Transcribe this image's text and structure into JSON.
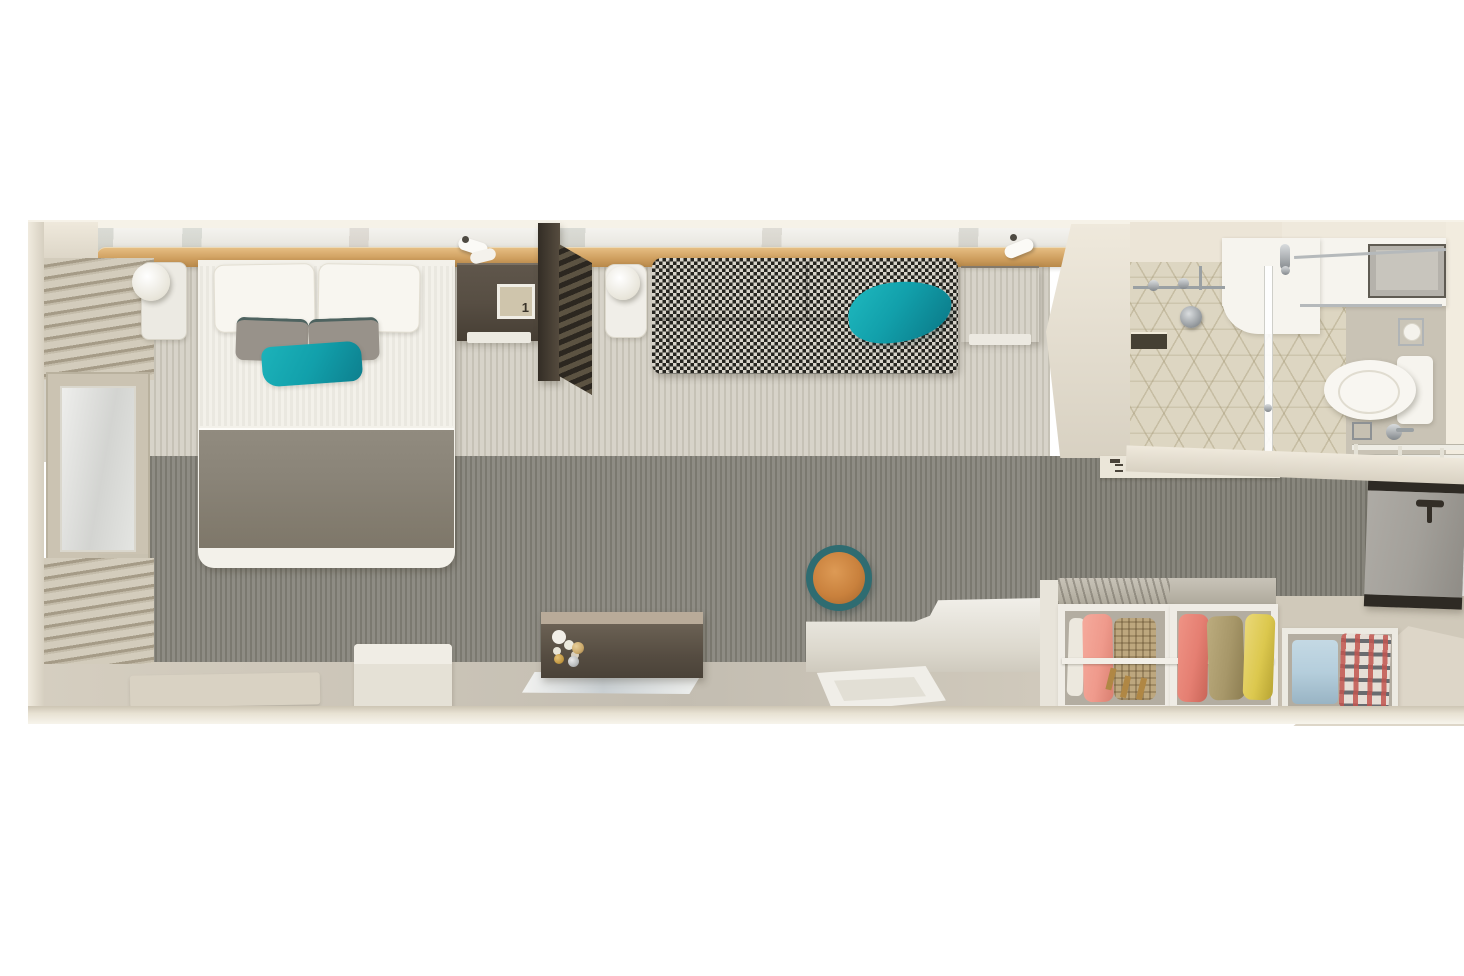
{
  "meta": {
    "label": "Top-down 3D floor plan of a stateroom cabin"
  },
  "artwork": {
    "digit": "1"
  },
  "colors": {
    "wall_cream": "#d8d1c2",
    "wall_light": "#efe9dc",
    "wood": "#cf9f5f",
    "marble": "#ebe9e3",
    "carpet_light": "#d7d3c9",
    "carpet_light_stripe": "#c6c2b6",
    "carpet_dark": "#8e8c84",
    "carpet_dark_stripe": "#7b7970",
    "floor_beige": "#d5cec0",
    "floor_entry": "#d0c9ba",
    "bed_white": "#f3f1ea",
    "blanket_gray": "#8a8478",
    "pillow_gray": "#98928a",
    "teal": "#12a0ab",
    "teal_deep": "#0d7f8e",
    "houndstooth_dark": "#25241f",
    "houndstooth_light": "#d8d4ca",
    "wood_dark": "#574e43",
    "divider_dark": "#3e372d",
    "stool_orange": "#c9813d",
    "stool_ring": "#2f6c71",
    "porcelain": "#f6f4ee",
    "chrome": "#a7abae",
    "tile": "#ddd6c2",
    "bath_floor_right": "#c9c3b5",
    "wardrobe_frame": "#efece5",
    "wardrobe_interior": "#b3ada1",
    "cloth_pink": "#ef9a8c",
    "cloth_salmon": "#e57f72",
    "cloth_tan": "#bda77e",
    "cloth_olive": "#a79769",
    "cloth_yellow": "#dcc84e",
    "cloth_blue": "#b5cedc",
    "door_gray": "#a3a09a",
    "door_trim": "#2e2a24",
    "hanger_gold": "#b08744"
  },
  "items": {
    "plan": "stateroom floor plan",
    "balcony_ledge": "balcony window ledge",
    "desk_ledge": "wooden desk ledge",
    "window": "window with mirror glass",
    "blinds": "window blinds",
    "bed": "queen bed",
    "pillow_white": "white pillow",
    "pillow_gray": "gray accent pillow",
    "pillow_teal": "teal throw pillow",
    "blanket": "gray bed runner",
    "nightstand": "marble nightstand",
    "lamp": "table lamp",
    "desk": "dark wood desk",
    "drawer": "drawer front",
    "picture": "framed artwork",
    "divider": "slatted room divider",
    "side_table": "marble side table",
    "sofa": "houndstooth sofa",
    "reading_light": "wall reading light",
    "sofa_side_table": "dark wood side table",
    "partition_wall": "bathroom partition wall",
    "coat_hooks": "coat hook rail",
    "stool": "round stool",
    "sideboard": "dark wood sideboard",
    "flowers": "orchid flowers",
    "runner_shelf": "glass shelf",
    "floor_mat": "floor mat",
    "bed_step": "step platform",
    "platform": "sofa platform step",
    "tray": "tray table",
    "wardrobe": "open wardrobe",
    "clothes_hanging": "hanging clothes",
    "clothes_folded": "folded clothes",
    "entry_door": "entry door",
    "shower": "shower enclosure",
    "shower_head": "shower head",
    "glass_panel": "glass partition",
    "vanity": "vanity counter with sink",
    "faucet": "faucet",
    "towel_shelf": "towel shelf",
    "toilet": "toilet",
    "tp_holder": "toilet paper holder",
    "towel_rail": "towel rail",
    "drain": "floor drain"
  }
}
